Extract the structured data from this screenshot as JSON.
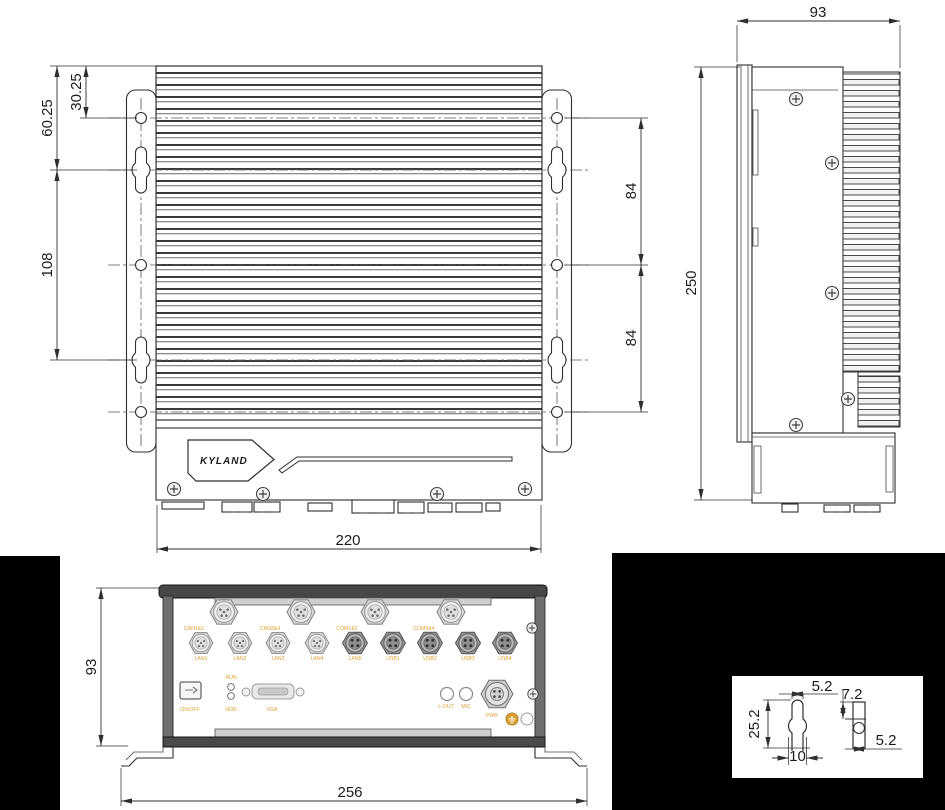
{
  "brand": {
    "logo_text": "KYLAND"
  },
  "colors": {
    "line": "#2f2f2f",
    "port_label_orange": "#dfa032",
    "background_black": "#000000",
    "connector_light": "#d8d8d8",
    "connector_dark": "#969696"
  },
  "front_view": {
    "dims": {
      "offset_small": "30.25",
      "offset_large": "60.25",
      "slot_pitch": "108",
      "hole_span_upper": "84",
      "hole_span_lower": "84",
      "body_width": "220"
    }
  },
  "side_view": {
    "dims": {
      "depth": "93",
      "height": "250"
    }
  },
  "bottom_view": {
    "dims": {
      "height": "93",
      "overall_width": "256"
    },
    "row1_labels": [
      "CAN1&2",
      "CAN3&4",
      "COM1&2",
      "COM3&4"
    ],
    "row2_labels": [
      "LAN1",
      "LAN2",
      "LAN3",
      "LAN4",
      "LAN5",
      "USB1",
      "USB2",
      "USB3",
      "USB4"
    ],
    "controls": {
      "power": "ON/OFF",
      "led_top": "RUN",
      "led_bottom": "HDD",
      "video": "VGA",
      "audio_out": "L-OUT",
      "mic": "MIC",
      "power_conn": "PWR"
    }
  },
  "detail_view": {
    "dims": {
      "slot_width": "5.2",
      "slot_length": "25.2",
      "bulge_width": "10",
      "depth": "7.2",
      "side_width": "5.2"
    }
  }
}
